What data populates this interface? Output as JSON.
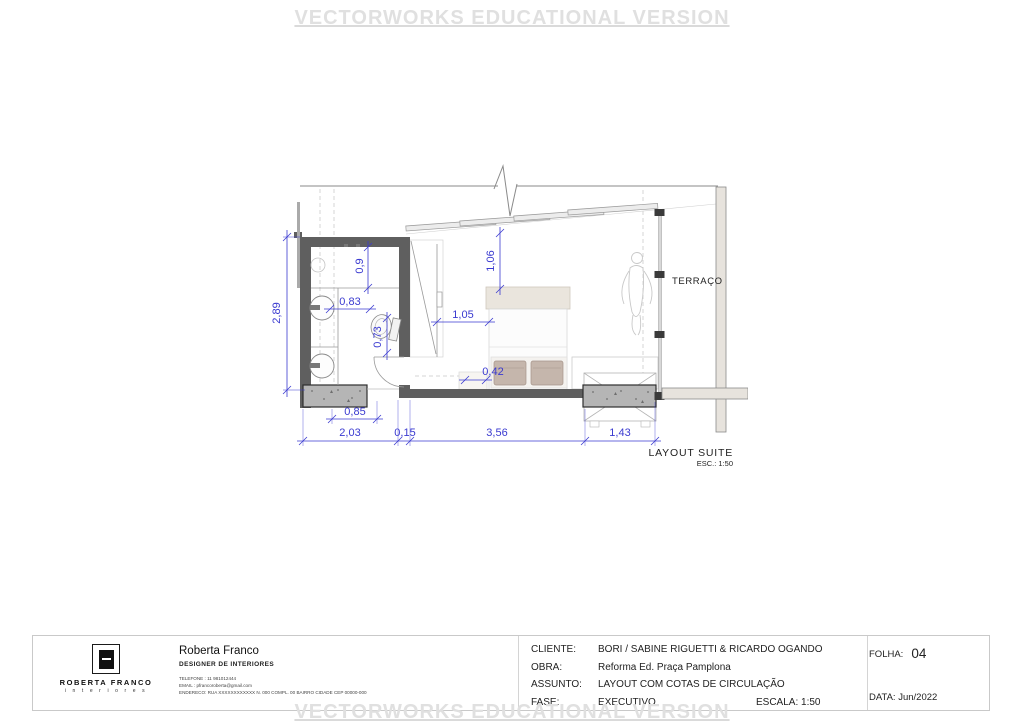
{
  "watermark": {
    "top": "VECTORWORKS EDUCATIONAL VERSION",
    "bottom": "VECTORWORKS EDUCATIONAL VERSION"
  },
  "plan": {
    "labels": {
      "terrace": "TERRAÇO",
      "title": "LAYOUT SUITE",
      "scale_note": "ESC.: 1:50"
    },
    "dimensions": {
      "bathroom_height": "2,89",
      "shower_width": "0,9",
      "vanity_clearance": "0,83",
      "toilet_clearance": "0,73",
      "bed_clearance_top": "1,06",
      "bed_clearance_left": "1,05",
      "door_clearance": "0,42",
      "concrete_left": "0,85",
      "bottom_chain": [
        "2,03",
        "0,15",
        "3,56",
        "1,43"
      ]
    },
    "colors": {
      "dimension_blue": "#3a3ad0",
      "wall_dark": "#5f5f5f",
      "concrete_gray": "#b5b5b5",
      "watermark_gray": "#e0e0e0"
    }
  },
  "titleblock": {
    "logo": {
      "name": "ROBERTA FRANCO",
      "subtitle": "i n t e r i o r e s"
    },
    "designer": {
      "name": "Roberta Franco",
      "role": "DESIGNER DE INTERIORES",
      "phone": "TELEFONE : 11 981012444",
      "email": "EMAIL : pfrancoroberta@gmail.com",
      "address": "ENDERECO: RUA XXXXXXXXXXXX    N. 000    COMPL. 00    BAIRRO    CIDADE    CEP 00000-000"
    },
    "fields": [
      {
        "label": "CLIENTE:",
        "value": "BORI / SABINE RIGUETTI & RICARDO OGANDO"
      },
      {
        "label": "OBRA:",
        "value": "Reforma Ed. Praça Pamplona"
      },
      {
        "label": "ASSUNTO:",
        "value": "LAYOUT COM COTAS DE CIRCULAÇÃO"
      },
      {
        "label": "FASE:",
        "value": "EXECUTIVO"
      }
    ],
    "escala": {
      "label": "ESCALA:",
      "value": "1:50"
    },
    "folha": {
      "label": "FOLHA:",
      "value": "04"
    },
    "data": {
      "label": "DATA:",
      "value": "Jun/2022"
    }
  }
}
